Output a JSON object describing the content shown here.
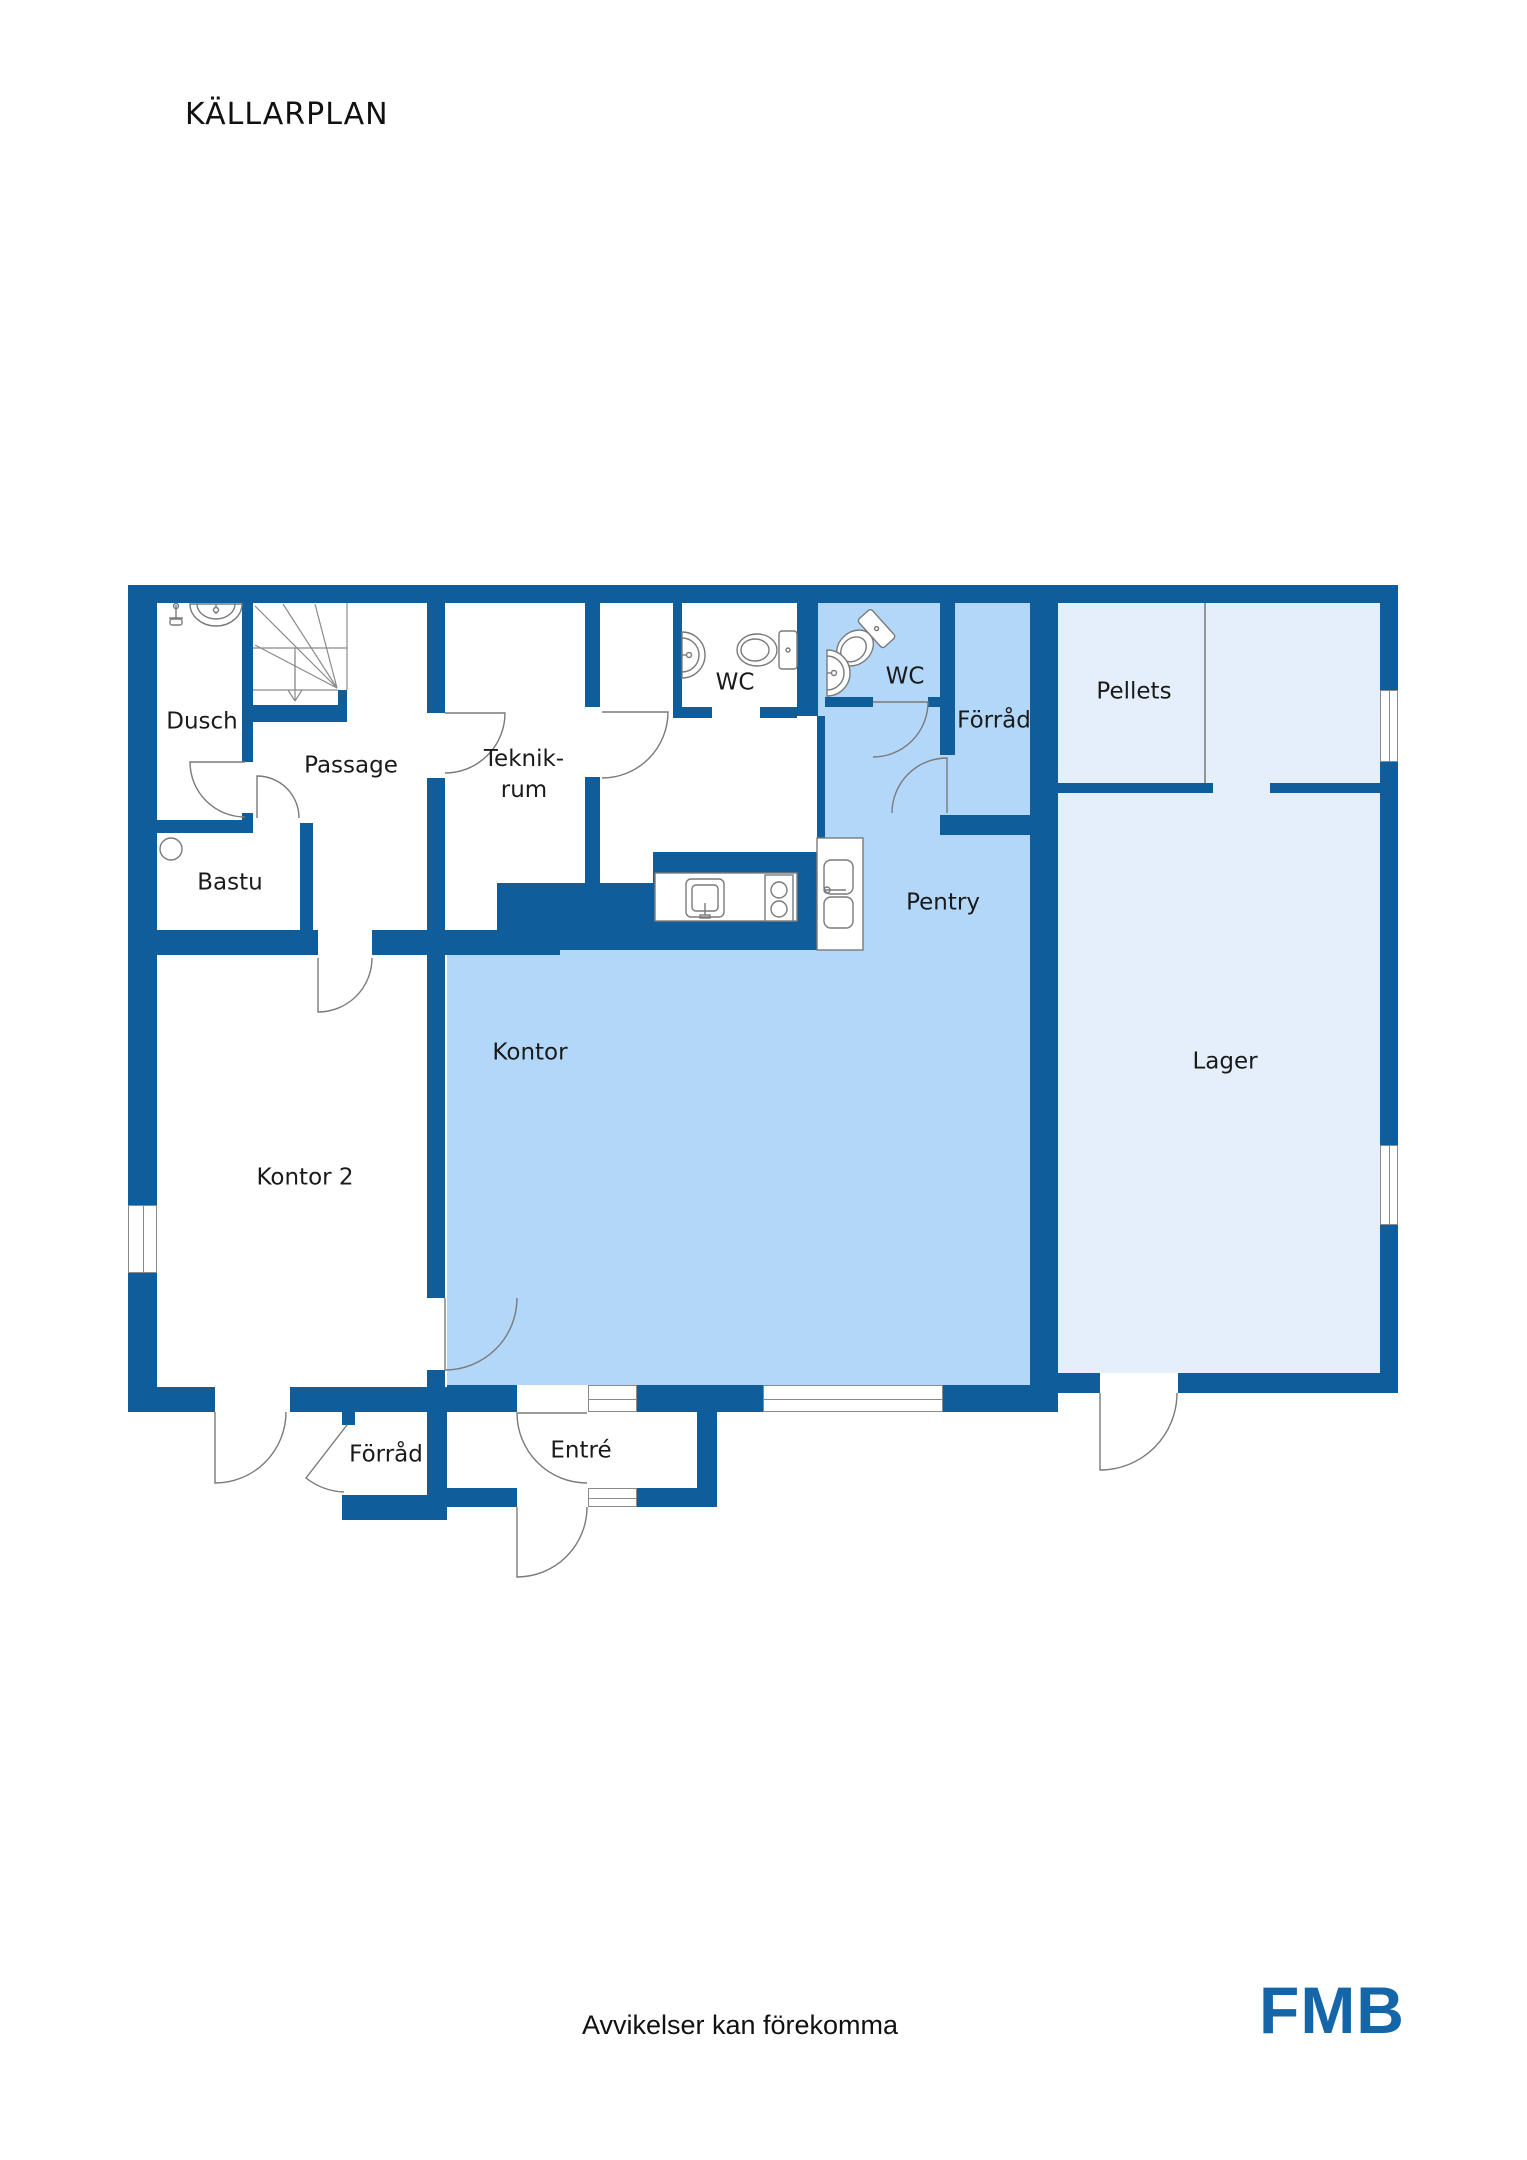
{
  "page": {
    "title": "KÄLLARPLAN",
    "footer_disclaimer": "Avvikelser kan förekomma",
    "brand_logo": "FMB"
  },
  "colors": {
    "wall": "#0f5e9b",
    "room-medium": "#b3d7f8",
    "room-pale": "#e4effb",
    "line": "#7a7a7a",
    "logo": "#1566a8",
    "text": "#1a1a1a"
  },
  "rooms": [
    {
      "id": "dusch",
      "label": "Dusch"
    },
    {
      "id": "passage",
      "label": "Passage"
    },
    {
      "id": "teknikrum",
      "label_line1": "Teknik-",
      "label_line2": "rum"
    },
    {
      "id": "wc-1",
      "label": "WC"
    },
    {
      "id": "wc-2",
      "label": "WC"
    },
    {
      "id": "forrad-top",
      "label": "Förråd"
    },
    {
      "id": "pellets",
      "label": "Pellets"
    },
    {
      "id": "bastu",
      "label": "Bastu"
    },
    {
      "id": "pentry",
      "label": "Pentry"
    },
    {
      "id": "lager",
      "label": "Lager"
    },
    {
      "id": "kontor-2",
      "label": "Kontor 2"
    },
    {
      "id": "kontor",
      "label": "Kontor"
    },
    {
      "id": "forrad-bottom",
      "label": "Förråd"
    },
    {
      "id": "entre",
      "label": "Entré"
    }
  ],
  "fixtures": [
    "stairs-down",
    "shower-mixer",
    "bathroom-sink",
    "toilet",
    "sauna-heater",
    "kitchen-sink",
    "stove",
    "double-sink",
    "window",
    "door"
  ]
}
